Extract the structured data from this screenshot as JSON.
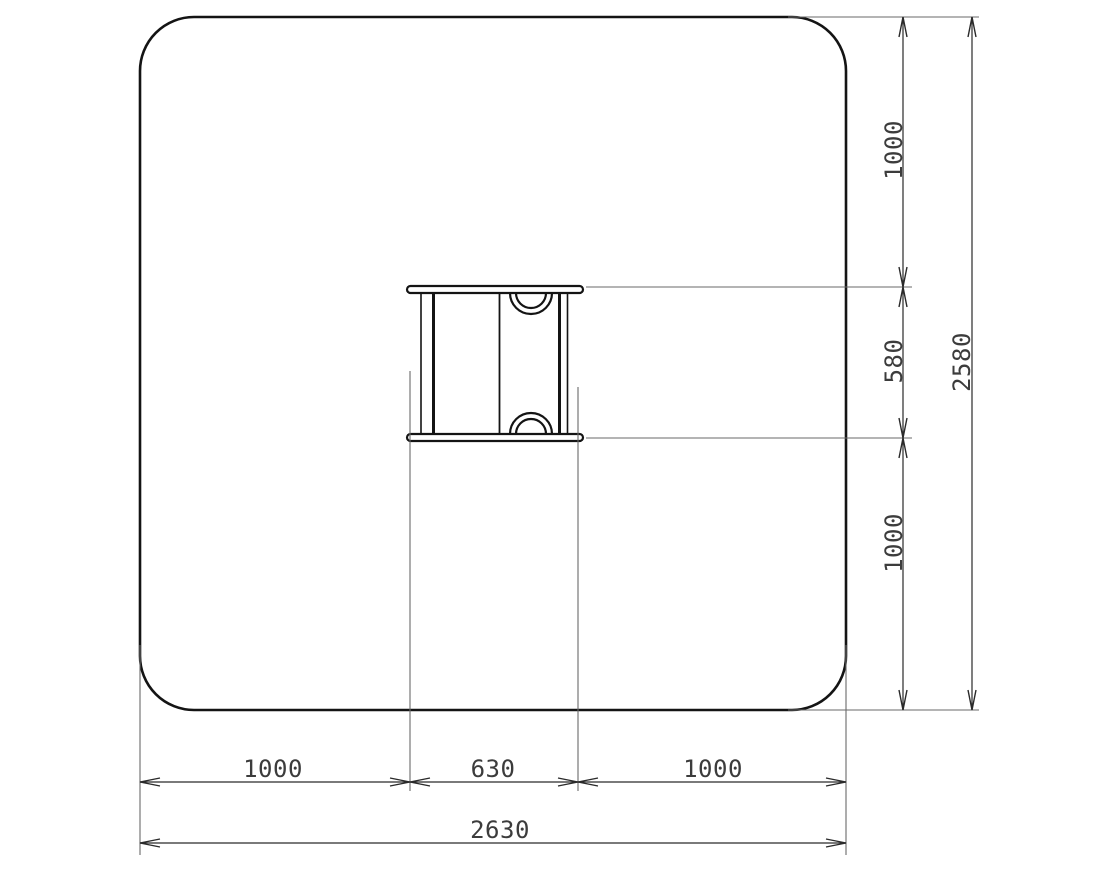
{
  "diagram": {
    "type": "dimensioned-plan-drawing",
    "background_color": "#ffffff",
    "outline_color": "#141414",
    "dimension_line_color": "#2a2a2a",
    "extension_line_color": "#6a6a6a",
    "label_color": "#3c3c3c",
    "labels": {
      "right_top": "1000",
      "right_middle": "580",
      "right_bottom": "1000",
      "right_overall": "2580",
      "bottom_left": "1000",
      "bottom_middle": "630",
      "bottom_right": "1000",
      "bottom_overall": "2630"
    }
  }
}
